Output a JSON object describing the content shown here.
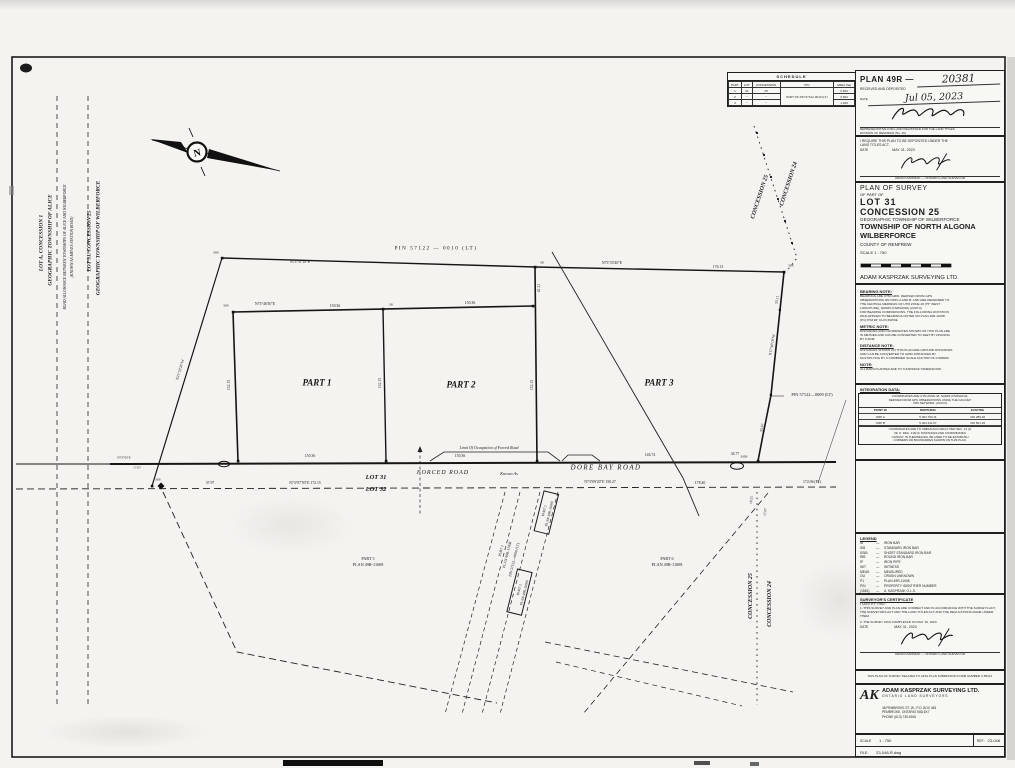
{
  "plan_box": {
    "label": "PLAN 49R —",
    "number": "20381",
    "received": "RECEIVED AND DEPOSITED",
    "date_label": "DATE",
    "date": "Jul 05, 2023",
    "reg1": "REPRESENTATIVE FOR LAND REGISTRAR FOR THE LAND TITLES",
    "reg2": "DIVISION OF RENFREW (No. 49)"
  },
  "require_box": {
    "l1": "I REQUIRE THIS PLAN TO BE DEPOSITED UNDER THE",
    "l2": "LAND TITLES ACT.",
    "date_label": "DATE",
    "date": "MAY 31, 2023",
    "name": "ADAM KASPRZAK",
    "title": "ONTARIO LAND SURVEYOR"
  },
  "title_block": {
    "t1": "PLAN OF SURVEY",
    "t2": "OF PART OF",
    "t3": "LOT 31",
    "t4": "CONCESSION 25",
    "t5": "GEOGRAPHIC TOWNSHIP OF WILBERFORCE",
    "t6": "TOWNSHIP OF NORTH ALGONA",
    "t7": "WILBERFORCE",
    "t8": "COUNTY OF RENFREW",
    "scale": "SCALE  1 : 750",
    "firm": "ADAM KASPRZAK SURVEYING LTD."
  },
  "notes": [
    {
      "h": "BEARING NOTE:",
      "lines": [
        "BEARINGS ARE UTM GRID, DERIVED FROM GPS",
        "OBSERVATIONS ON ORPs A AND B, AND ARE REFERRED TO",
        "THE CENTRAL MERIDIAN OF UTM ZONE 18 (75° WEST",
        "LONGITUDE), NAD83 (CSRS2010) (2010.0)."
      ]
    },
    {
      "h": "",
      "lines": [
        "FOR BEARING COMPARISONS, THE FOLLOWING ROTATION",
        "WAS APPLIED TO BEARINGS NOTED ON PLAN 49R-11008:",
        "(P1)        0°02'20\"  CLOCKWISE"
      ]
    },
    {
      "h": "METRIC NOTE:",
      "lines": [
        "DISTANCES AND COORDINATES SHOWN ON THIS PLAN ARE",
        "IN METRES AND CAN BE CONVERTED TO FEET BY DIVIDING",
        "BY 0.3048."
      ]
    },
    {
      "h": "DISTANCE NOTE:",
      "lines": [
        "DISTANCES SHOWN ON THIS PLAN ARE GROUND DISTANCES",
        "AND CAN BE CONVERTED TO GRID DISTANCES BY",
        "MULTIPLYING BY A COMBINED SCALE FACTOR OF 0.999609."
      ]
    },
    {
      "h": "NOTE:",
      "lines": [
        "ALL BARS PLANTED ARE TO 'KASPRZAK' DIMENSIONS."
      ]
    }
  ],
  "integration": {
    "heading": "INTEGRATION DATA:",
    "intro": [
      "COORDINATES ARE UTM ZONE 18, NAD83 (CSRS2010),",
      "DERIVED FROM GPS OBSERVATIONS USING THE CAN-NET",
      "VRS NETWORK.  (2010.0)"
    ],
    "cols": [
      "POINT ID",
      "NORTHING",
      "EASTING"
    ],
    "rows": [
      [
        "ORP A",
        "5 064 793.11",
        "332 289.46"
      ],
      [
        "ORP B",
        "5 064 411.07",
        "332 501.29"
      ]
    ],
    "footer": [
      "COORDINATES ARE TO URBAN ACCURACY PER SEC. 14 (2)",
      "OF O. REG. 216/10.  DISTANCES AND COORDINATES",
      "CANNOT, IN THEMSELVES, BE USED TO RE-ESTABLISH",
      "CORNERS OR BOUNDARIES SHOWN ON THIS PLAN."
    ]
  },
  "legend": {
    "heading": "LEGEND",
    "items": [
      [
        "IB",
        "IRON BAR"
      ],
      [
        "SIB",
        "STANDARD IRON BAR"
      ],
      [
        "SSIB",
        "SHORT STANDARD IRON BAR"
      ],
      [
        "RIB",
        "ROUND IRON BAR"
      ],
      [
        "IP",
        "IRON PIPE"
      ],
      [
        "WIT",
        "WITNESS"
      ],
      [
        "MEAS",
        "MEASURED"
      ],
      [
        "OU",
        "ORIGIN UNKNOWN"
      ],
      [
        "P1",
        "PLAN 49R-11008"
      ],
      [
        "PIN",
        "PROPERTY IDENTIFIER NUMBER"
      ],
      [
        "(1561)",
        "A. KASPRZAK  O.L.S."
      ],
      [
        "NTS",
        "NOT TO SCALE"
      ]
    ]
  },
  "certificate": {
    "heading": "SURVEYOR'S CERTIFICATE",
    "intro": "I CERTIFY THAT:",
    "item1": "1.  THIS SURVEY AND PLAN ARE CORRECT AND IN ACCORDANCE WITH THE SURVEYS ACT, THE SURVEYORS ACT AND THE LAND TITLES ACT AND THE REGULATIONS MADE UNDER THEM.",
    "item2": "2.  THE SURVEY WAS COMPLETED ON MAY 16, 2023.",
    "date_label": "DATE",
    "date": "MAY 31, 2023",
    "name": "ADAM KASPRZAK",
    "title": "ONTARIO LAND SURVEYOR"
  },
  "relates_note": "THIS PLAN OF SURVEY RELATES TO AKSL PLAN SUBMISSION FORM NUMBER  V-58113.",
  "company": {
    "logo": "AK",
    "name": "ADAM KASPRZAK SURVEYING LTD.",
    "sub": "ONTARIO LAND SURVEYORS",
    "a1": "48 PEMBROKE ST. W.,   P.O. BOX 463",
    "a2": "PEMBROKE, ONTARIO   K8A 6X7",
    "a3": "PHONE (613) 735-6916"
  },
  "footer": {
    "scale_label": "SCALE",
    "scale_value": "1 : 750",
    "ref_label": "REF:",
    "ref_value": "23-048",
    "file_label": "FILE:",
    "file_value": "23-048-R.dwg"
  },
  "schedule": {
    "title": "SCHEDULE",
    "headers": [
      "PART",
      "LOT",
      "CONCESSION",
      "PIN",
      "AREA (ha)"
    ],
    "pin": "PART OF PIN 57122-0010 (LT)",
    "rows": [
      [
        "1",
        "31",
        "25",
        "0.822"
      ],
      [
        "2",
        "\"",
        "\"",
        "0.822"
      ],
      [
        "3",
        "\"",
        "\"",
        "1.645"
      ]
    ]
  },
  "map": {
    "north": "N",
    "labels": [
      [
        "pin-top-label",
        436,
        249,
        "PIN   57122 — 0010   (LT)",
        5.2,
        0,
        0,
        0,
        1.5
      ],
      [
        "part1-label",
        317,
        383,
        "PART 1",
        9,
        0,
        1,
        1
      ],
      [
        "part2-label",
        461,
        385,
        "PART 2",
        9,
        0,
        1,
        1
      ],
      [
        "part3-label",
        659,
        383,
        "PART 3",
        9,
        0,
        1,
        1
      ],
      [
        "forced-road-label",
        443,
        473,
        "FORCED  ROAD",
        6,
        0,
        0,
        1,
        1
      ],
      [
        "known-as-label",
        509,
        474,
        "Known As",
        4.4,
        0,
        0,
        1
      ],
      [
        "dore-bay-road-label",
        606,
        469,
        "DORE  BAY  ROAD",
        6.8,
        0,
        0,
        1,
        1.5
      ],
      [
        "lot31-label",
        376,
        478,
        "LOT   31",
        6.5,
        0,
        1,
        1
      ],
      [
        "lot32-label",
        376,
        490,
        "LOT   32",
        6.5,
        0,
        1,
        1
      ],
      [
        "part5-label",
        368,
        559,
        "PART 5",
        4.2
      ],
      [
        "part5-plan-label",
        368,
        565,
        "PLAN 49R-11008",
        4.2
      ],
      [
        "part6-label",
        667,
        559,
        "PART 6",
        4.2
      ],
      [
        "part6-plan-label",
        667,
        565,
        "PLAN 49R-11008",
        4.2
      ],
      [
        "concession-25-ne-label",
        760,
        197,
        "CONCESSION  25",
        6,
        -72,
        1,
        1
      ],
      [
        "concession-24-ne-label",
        789,
        184,
        "CONCESSION  24",
        6,
        -72,
        1,
        1
      ],
      [
        "concession-25-se-label",
        751,
        596,
        "CONCESSION  25",
        6,
        -90,
        1,
        1
      ],
      [
        "concession-24-se-label",
        770,
        604,
        "CONCESSION  24",
        6,
        -90,
        1,
        1
      ],
      [
        "lot-a-concession-1-label",
        42,
        243,
        "LOT  A,   CONCESSION  1",
        5.4,
        -90,
        1,
        1
      ],
      [
        "township-of-alice-label",
        51,
        240,
        "GEOGRAPHIC  TOWNSHIP  OF  ALICE",
        5.4,
        -90,
        1,
        1
      ],
      [
        "road-allowance-label-1",
        66,
        247,
        "ROAD ALLOWANCE BETWEEN TOWNSHIPS OF ALICE AND WILBERFORCE",
        3.8,
        -90,
        0,
        1
      ],
      [
        "road-allowance-label-2",
        73,
        247,
        "(KNOWN AS MEVES STATION ROAD)",
        3.8,
        -90,
        0,
        1
      ],
      [
        "lot-31-concession-25-label",
        90,
        241,
        "LOT  31,   CONCESSION  25",
        5.4,
        -90,
        1,
        1
      ],
      [
        "township-of-wilberforce-label",
        99,
        238,
        "GEOGRAPHIC  TOWNSHIP  OF  WILBERFORCE",
        5.4,
        -90,
        1,
        1
      ],
      [
        "limit-of-occupation-label",
        489,
        448,
        "Limit Of Occupation of Forced Road",
        4,
        0,
        0,
        1
      ],
      [
        "pin-0009-label",
        812,
        395,
        "PIN  57122—0009  (LT)",
        4.4
      ],
      [
        "strip-part1-label",
        502,
        551,
        "PART 1",
        3.7,
        -76
      ],
      [
        "strip-plan-label",
        508,
        555,
        "PLAN 49R-11008",
        3.7,
        -76
      ],
      [
        "strip-pin-label",
        515,
        560,
        "PIN 57122—0000 (LT)",
        3.7,
        -76
      ],
      [
        "recta-part2-label",
        545,
        511,
        "PART 2",
        3.5,
        -76
      ],
      [
        "recta-plan-label",
        550,
        514,
        "PLAN 49R-11008",
        3.5,
        -76
      ],
      [
        "rectb-part3-label",
        520,
        590,
        "PART 3",
        3.5,
        -76
      ],
      [
        "rectb-plan-label",
        525,
        593,
        "PLAN 49R-11008",
        3.5,
        -76
      ],
      [
        "dim-severance-bearing",
        265,
        305,
        "N73°46'30\"E"
      ],
      [
        "dim-severance-dist-1",
        335,
        307,
        "150.36"
      ],
      [
        "dim-severance-dist-2",
        470,
        304,
        "150.36"
      ],
      [
        "dim-top-bearing",
        300,
        263,
        "N73°51'10\"E"
      ],
      [
        "dim-part3-top-bearing",
        612,
        264,
        "N73°55'40\"E"
      ],
      [
        "dim-part3-top-dist",
        718,
        268,
        "176.13"
      ],
      [
        "dim-part1-west",
        230,
        385,
        "152.15",
        3.8,
        -90
      ],
      [
        "dim-part12-line",
        381,
        383,
        "152.15",
        3.8,
        -90
      ],
      [
        "dim-part23-line",
        533,
        385,
        "152.15",
        3.8,
        -90
      ],
      [
        "dim-part23-upper",
        540,
        288,
        "41.21",
        3.8,
        -90
      ],
      [
        "dim-part3-east-bearing",
        773,
        345,
        "N17°40'10\"W",
        3.8,
        -80
      ],
      [
        "dim-part3-east-1",
        778,
        300,
        "55.11",
        3.8,
        -80
      ],
      [
        "dim-part3-east-2",
        763,
        428,
        "35.67",
        3.8,
        -80
      ],
      [
        "dim-part1-south",
        310,
        457,
        "150.36"
      ],
      [
        "dim-part2-south",
        460,
        457,
        "150.36"
      ],
      [
        "dim-part3-south",
        650,
        456,
        "146.74"
      ],
      [
        "dim-part3-south-2",
        735,
        455,
        "34.77"
      ],
      [
        "dim-road-1",
        210,
        484,
        "37.97"
      ],
      [
        "dim-road-bearing-1",
        305,
        484,
        "N73°07'50\"E  172.15"
      ],
      [
        "dim-road-bearing-2",
        600,
        483,
        "N73°09'20\"E  150.27"
      ],
      [
        "dim-road-2",
        700,
        484,
        "178.40"
      ],
      [
        "dim-road-3",
        812,
        483,
        "172.06 (P1)"
      ],
      [
        "dim-west-boundary",
        181,
        370,
        "N21°33'20\"W",
        3.8,
        -73
      ],
      [
        "mon-sib-1",
        226,
        306,
        "SIB",
        3.3
      ],
      [
        "mon-sib-2",
        216,
        253,
        "SIB",
        3.3
      ],
      [
        "mon-sib-3",
        158,
        480,
        "SIB",
        3.3
      ],
      [
        "mon-ib-1",
        391,
        305,
        "IB",
        3.3
      ],
      [
        "mon-ib-2",
        542,
        263,
        "IB",
        3.3
      ],
      [
        "mon-sib-4",
        791,
        266,
        "SIB",
        3.3
      ],
      [
        "mon-ssib-1",
        744,
        457,
        "SSIB",
        3.3
      ],
      [
        "dim-junction-1",
        752,
        500,
        "19.25",
        3.5,
        -85
      ],
      [
        "dim-junction-2",
        766,
        512,
        "17.07",
        3.5,
        -85
      ],
      [
        "dim-left-road-bearing",
        124,
        458,
        "N73°05'E",
        3.5
      ],
      [
        "dim-left-road-dist",
        137,
        468,
        "17.07",
        3.5
      ]
    ]
  }
}
